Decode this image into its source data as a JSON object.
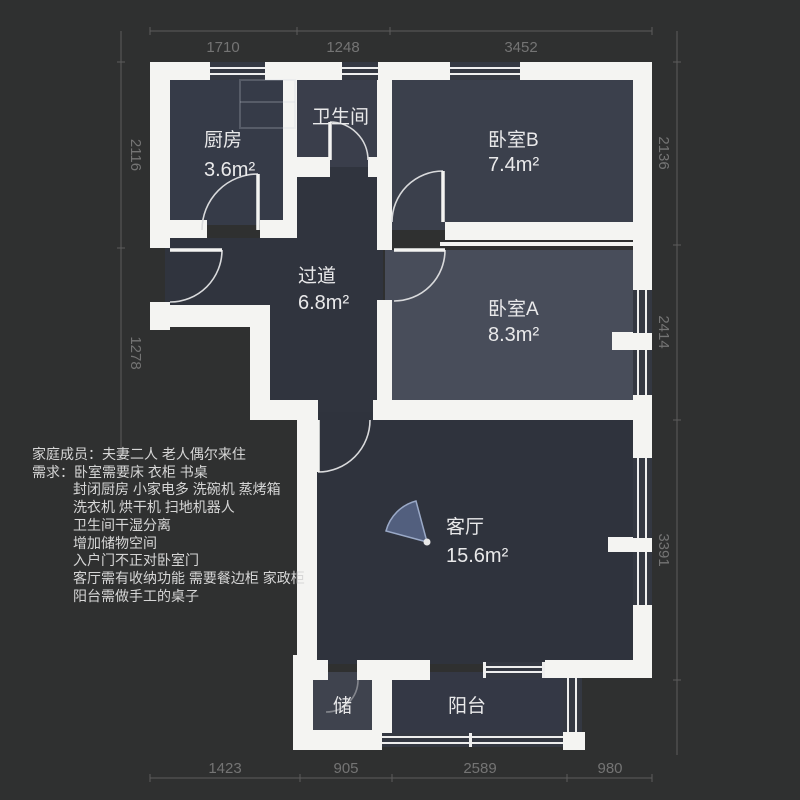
{
  "title": "apartment-floorplan",
  "plan": {
    "rooms": [
      {
        "id": "kitchen",
        "name": "厨房",
        "area": "3.6m²"
      },
      {
        "id": "bathroom",
        "name": "卫生间",
        "area": ""
      },
      {
        "id": "bedroom-b",
        "name": "卧室B",
        "area": "7.4m²"
      },
      {
        "id": "hallway",
        "name": "过道",
        "area": "6.8m²"
      },
      {
        "id": "bedroom-a",
        "name": "卧室A",
        "area": "8.3m²"
      },
      {
        "id": "living-room",
        "name": "客厅",
        "area": "15.6m²"
      },
      {
        "id": "storage",
        "name": "储",
        "area": ""
      },
      {
        "id": "balcony",
        "name": "阳台",
        "area": ""
      }
    ],
    "dimensions": {
      "top": [
        "1710",
        "1248",
        "3452"
      ],
      "left": [
        "2116",
        "1278"
      ],
      "right": [
        "2136",
        "2414",
        "3391"
      ],
      "bottom": [
        "1423",
        "905",
        "2589",
        "980"
      ]
    },
    "icons": [
      "camera-view-icon"
    ]
  },
  "notes": {
    "lines": [
      {
        "indent": false,
        "text": "家庭成员：夫妻二人 老人偶尔来住"
      },
      {
        "indent": false,
        "text": "需求：卧室需要床 衣柜 书桌"
      },
      {
        "indent": true,
        "text": "封闭厨房 小家电多 洗碗机 蒸烤箱"
      },
      {
        "indent": true,
        "text": "洗衣机 烘干机 扫地机器人"
      },
      {
        "indent": true,
        "text": "卫生间干湿分离"
      },
      {
        "indent": true,
        "text": "增加储物空间"
      },
      {
        "indent": true,
        "text": "入户门不正对卧室门"
      },
      {
        "indent": true,
        "text": "客厅需有收纳功能 需要餐边柜 家政柜"
      },
      {
        "indent": true,
        "text": "阳台需做手工的桌子"
      }
    ]
  },
  "colors": {
    "background": "#2f3030",
    "wall": "#f4f4f2",
    "window_slot": "#343842",
    "window_line": "#eeeeee",
    "door_arc": "#d9dadc",
    "room_label": "#e9e9ea",
    "notes_text": "#d6d6d6",
    "dim_line": "#5c5c5c",
    "dim_text": "#747474",
    "camera_fan_fill": "#525f7e",
    "camera_fan_stroke": "#9aa9c7",
    "rooms": {
      "kitchen": "#363b48",
      "bathroom": "#3a3e4b",
      "bedroom-b": "#3b404c",
      "hallway": "#30343e",
      "bedroom-a": "#484d5a",
      "living-room": "#2f333d",
      "storage": "#3f434e",
      "balcony": "#343845"
    }
  }
}
